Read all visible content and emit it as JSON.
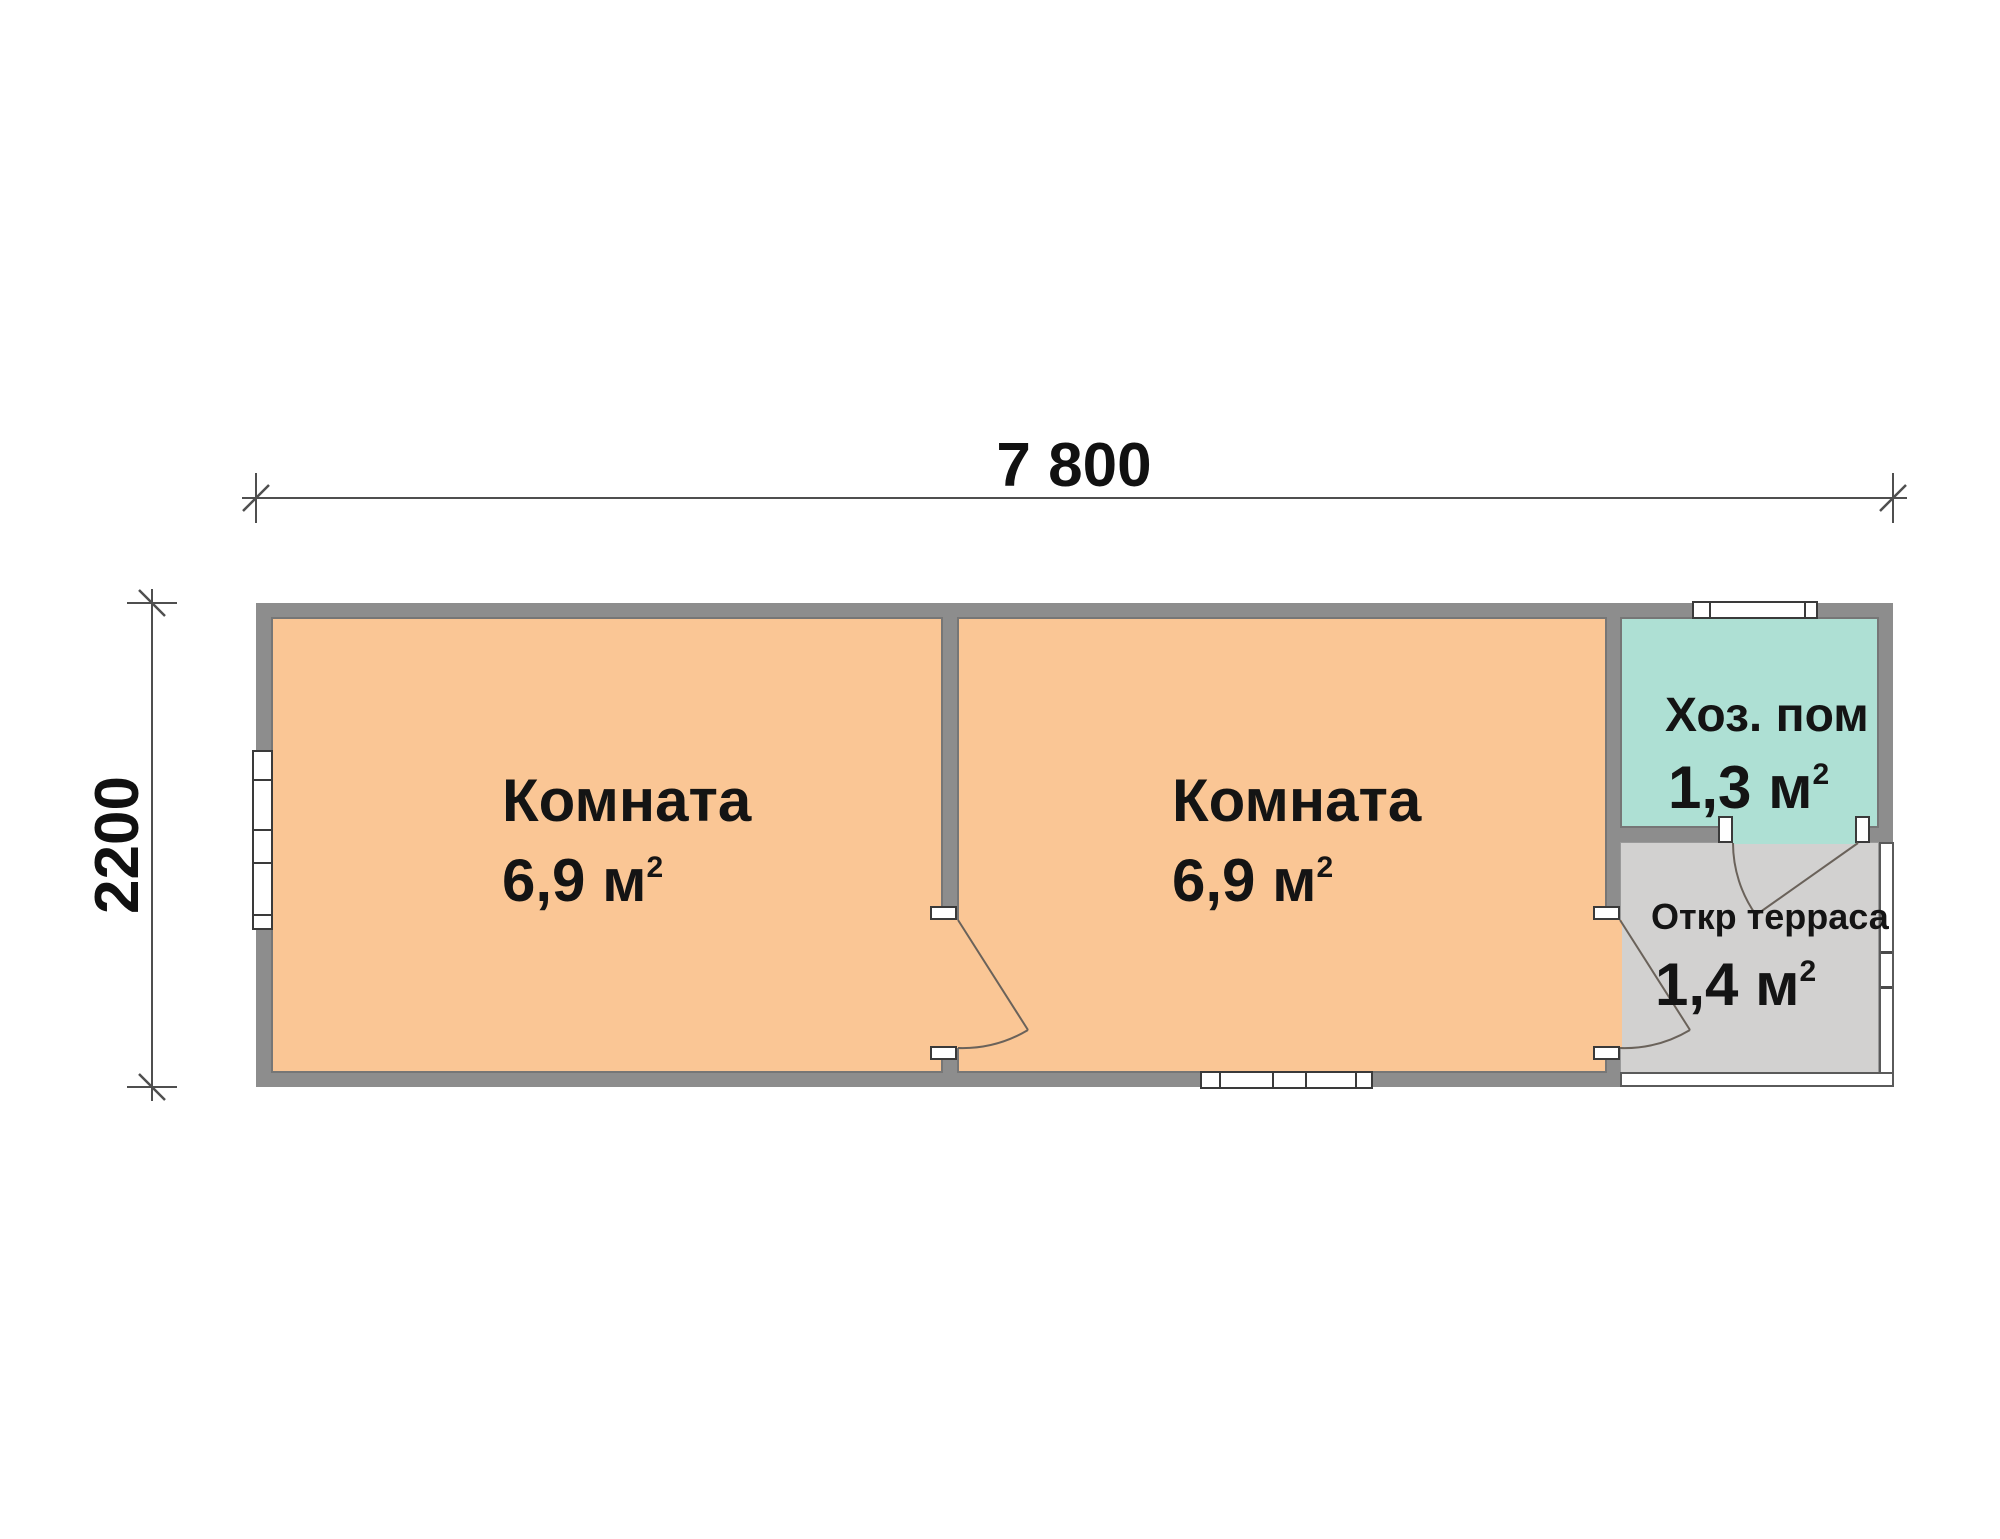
{
  "drawing_type": "floor-plan",
  "dimensions": {
    "width_label": "7 800",
    "height_label": "2200"
  },
  "rooms": [
    {
      "name": "Комната",
      "area": "6,9 м",
      "area_sup": "2"
    },
    {
      "name": "Комната",
      "area": "6,9 м",
      "area_sup": "2"
    },
    {
      "name": "Хоз. пом",
      "area": "1,3 м",
      "area_sup": "2"
    },
    {
      "name": "Откр терраса",
      "area": "1,4 м",
      "area_sup": "2"
    }
  ],
  "colors": {
    "wall": "#8d8d8d",
    "room_fill": "#fac695",
    "utility_fill": "#aee0d4",
    "terrace_fill": "#d2d1d0",
    "window_frame": "#3a3a3a",
    "dimension_line": "#4f4f4f",
    "door_line": "#6a625a",
    "text": "#141414"
  }
}
